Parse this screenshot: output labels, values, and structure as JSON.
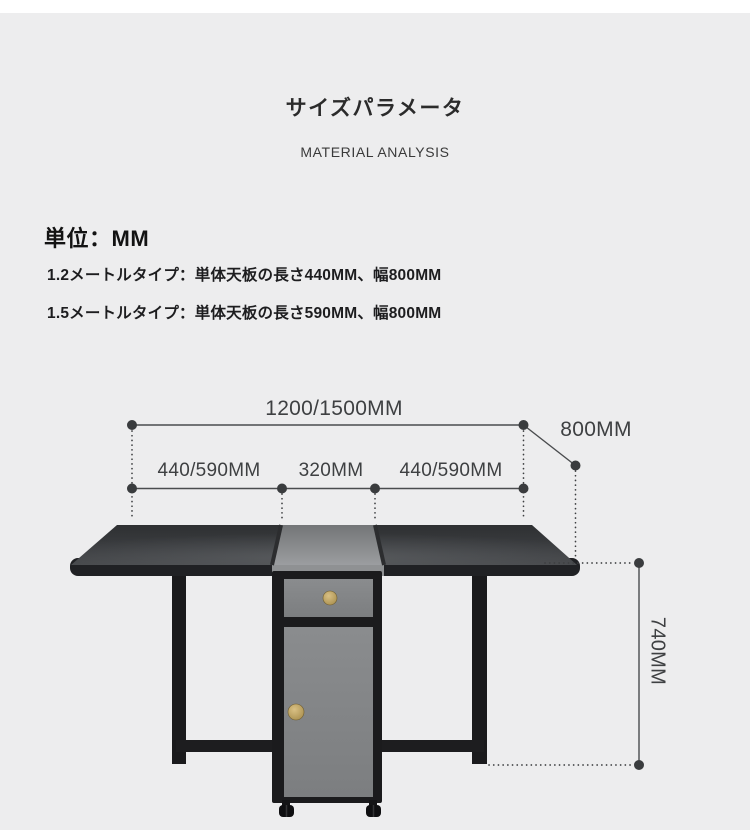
{
  "page": {
    "title": "サイズパラメータ",
    "subtitle": "MATERIAL ANALYSIS",
    "unit_heading": "単位：MM",
    "spec_lines": [
      "1.2メートルタイプ：単体天板の長さ440MM、幅800MM",
      "1.5メートルタイプ：単体天板の長さ590MM、幅800MM"
    ]
  },
  "dimensions": {
    "total_length": "1200/1500MM",
    "depth": "800MM",
    "left_leaf": "440/590MM",
    "center_section": "320MM",
    "right_leaf": "440/590MM",
    "height": "740MM"
  },
  "colors": {
    "background": "#ededee",
    "top_strip": "#ffffff",
    "text_dark": "#1d1d1f",
    "dimension_line": "#3e4042",
    "tabletop_dark": "#35373a",
    "cabinet_gray": "#828486",
    "knob_gold": "#b79c58"
  }
}
